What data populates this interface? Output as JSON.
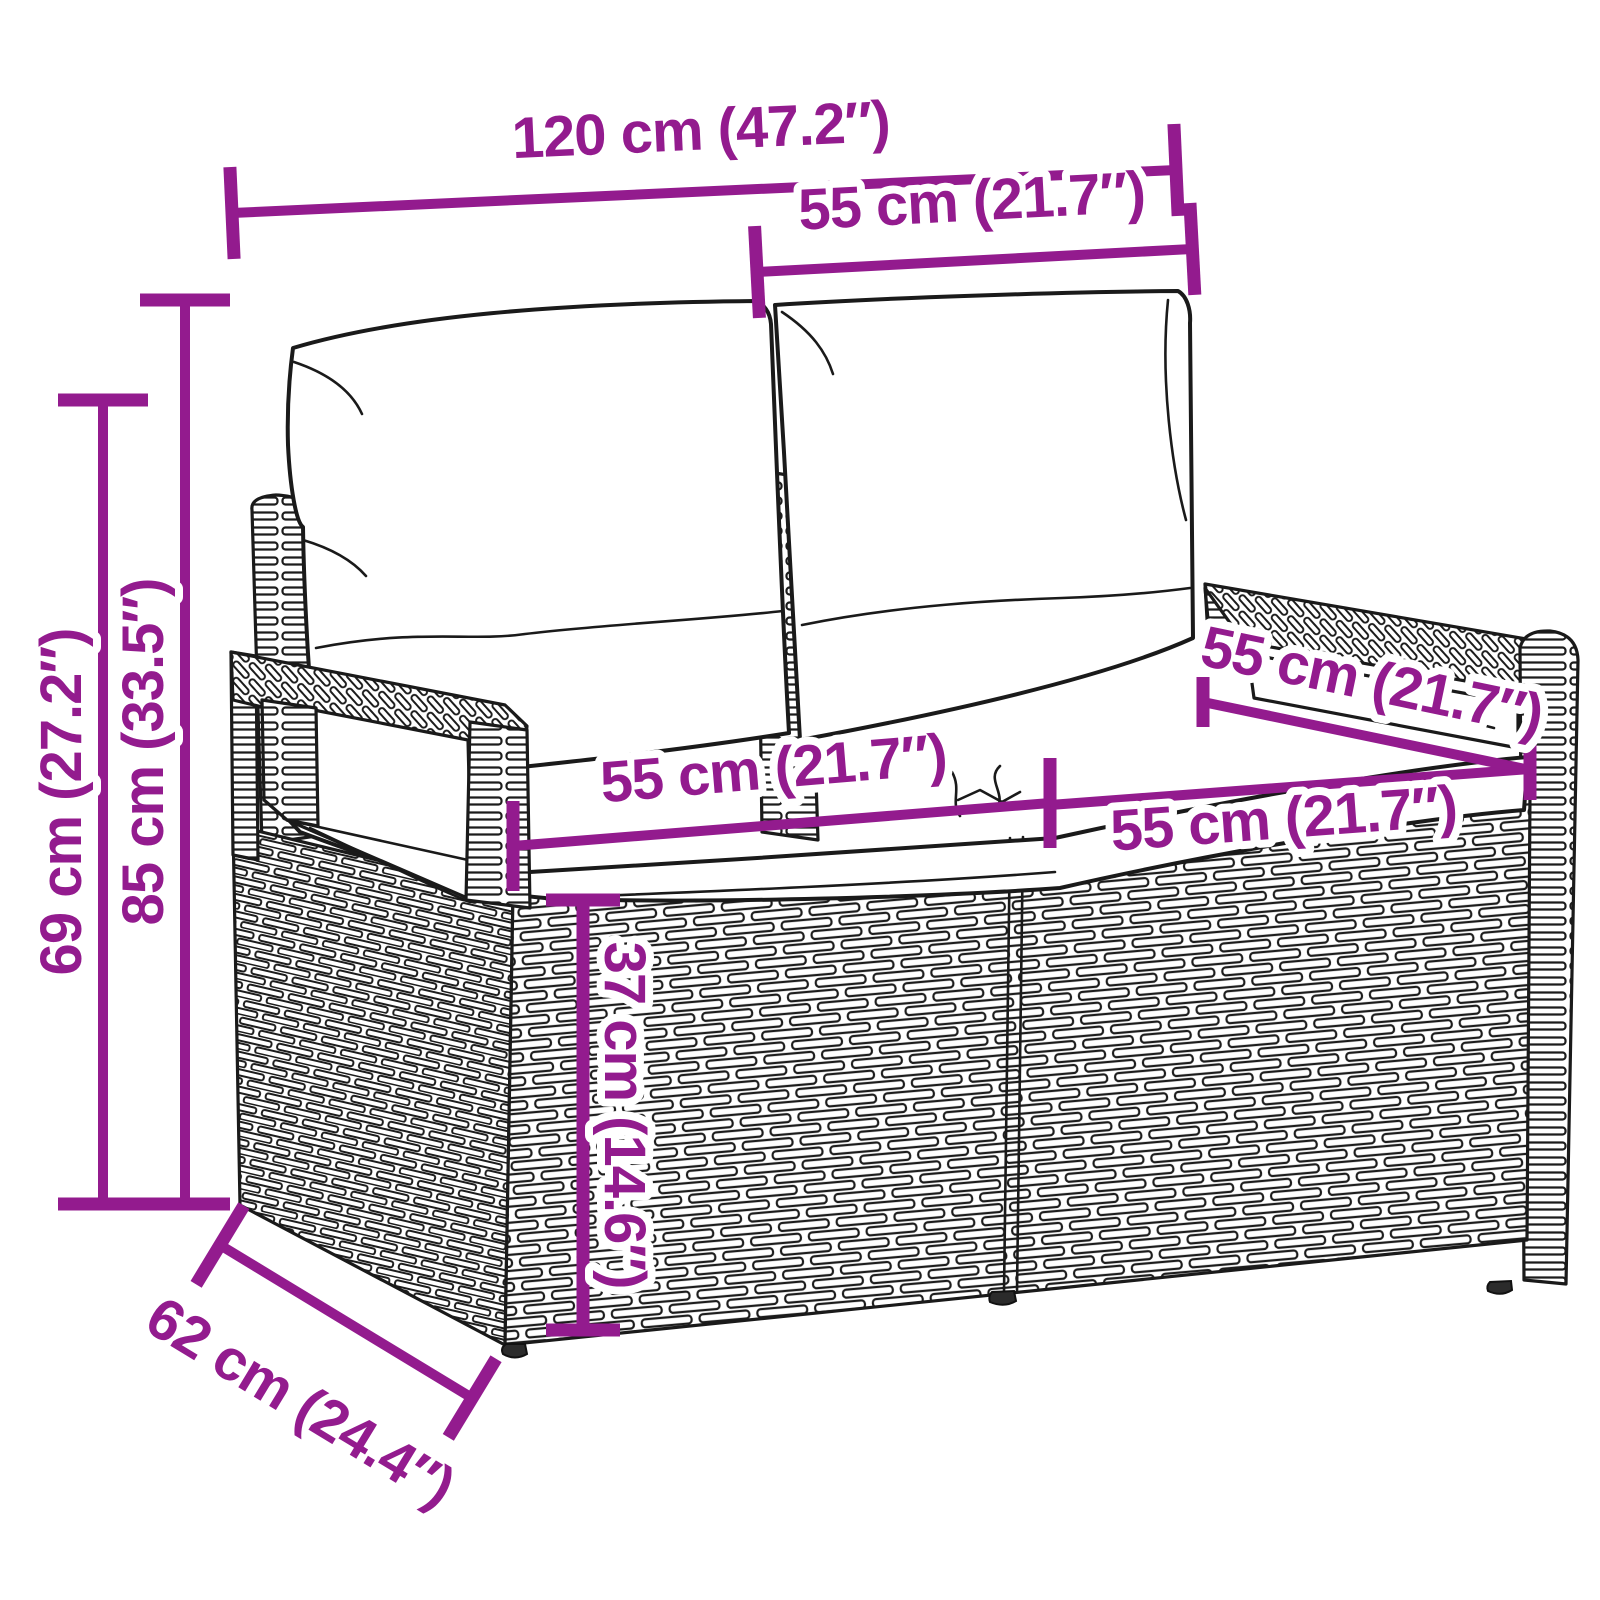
{
  "diagram": {
    "title": "Garden bench dimension diagram",
    "product": "poly rattan 2-seater garden bench with cushions",
    "style": {
      "accent_color": "#931B8E",
      "ink_color": "#1A1A1A",
      "background_color": "#FFFFFF"
    },
    "dimensions": {
      "overall_width": {
        "name": "overall width",
        "label": "120 cm (47.2″)"
      },
      "section_width_back": {
        "name": "seat section width (back)",
        "label": "55 cm (21.7″)"
      },
      "total_height": {
        "name": "total height with cushions",
        "label": "85 cm (33.5″)"
      },
      "frame_height": {
        "name": "frame height",
        "label": "69 cm (27.2″)"
      },
      "seat_depth": {
        "name": "seat depth",
        "label": "55 cm (21.7″)"
      },
      "seat_width_left": {
        "name": "left seat width",
        "label": "55 cm (21.7″)"
      },
      "seat_width_right": {
        "name": "right seat width",
        "label": "55 cm (21.7″)"
      },
      "seat_height": {
        "name": "seat height",
        "label": "37 cm (14.6″)"
      },
      "overall_depth": {
        "name": "overall depth",
        "label": "62 cm (24.4″)"
      }
    }
  }
}
